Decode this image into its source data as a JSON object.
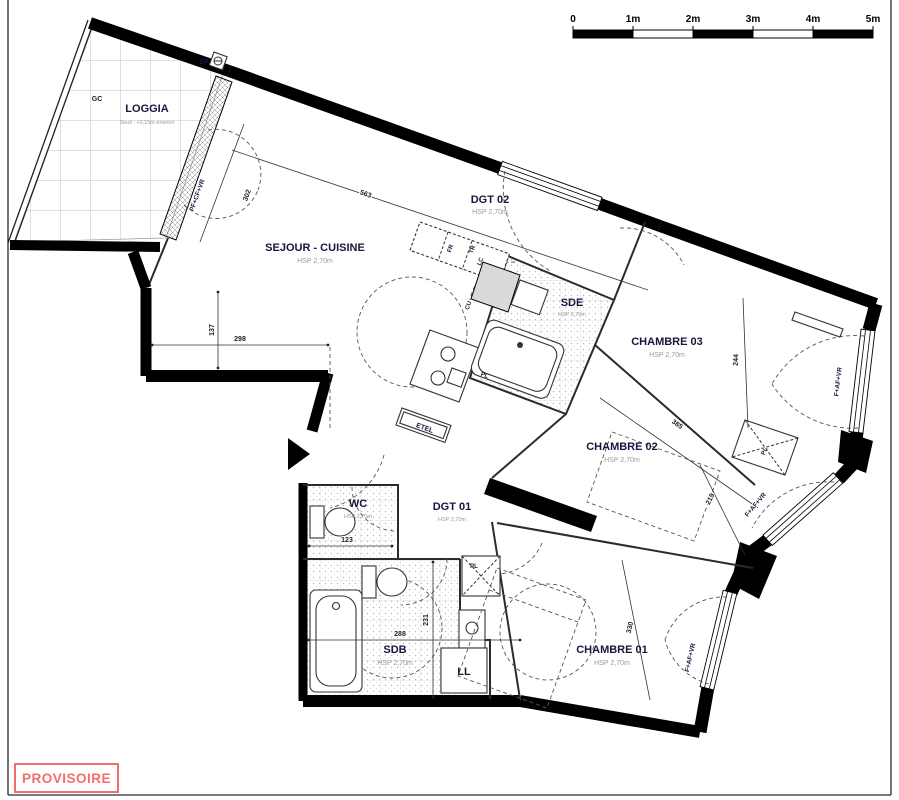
{
  "scale_bar": {
    "labels": [
      "0",
      "1m",
      "2m",
      "3m",
      "4m",
      "5m"
    ]
  },
  "stamp": {
    "label": "PROVISOIRE",
    "color": "#f26d6d"
  },
  "rooms": [
    {
      "id": "loggia",
      "name": "LOGGIA",
      "sub": "Seuil : +0,15m environ"
    },
    {
      "id": "sejour",
      "name": "SEJOUR - CUISINE",
      "sub": "HSP 2,70m"
    },
    {
      "id": "dgt02",
      "name": "DGT 02",
      "sub": "HSP 2,70m"
    },
    {
      "id": "sde",
      "name": "SDE",
      "sub": "HSP 2,70m"
    },
    {
      "id": "chambre03",
      "name": "CHAMBRE 03",
      "sub": "HSP 2,70m"
    },
    {
      "id": "chambre02",
      "name": "CHAMBRE 02",
      "sub": "HSP 2,70m"
    },
    {
      "id": "chambre01",
      "name": "CHAMBRE 01",
      "sub": "HSP 2,70m"
    },
    {
      "id": "wc",
      "name": "WC",
      "sub": "HSP 2,70m"
    },
    {
      "id": "dgt01",
      "name": "DGT 01",
      "sub": "HSP 2,70m"
    },
    {
      "id": "sdb",
      "name": "SDB",
      "sub": "HSP 2,70m"
    }
  ],
  "equipment": {
    "ll": "LL",
    "etel": "ETEL",
    "ep": "EP",
    "gc": "GC",
    "pl_ch03": "PL",
    "pl_dgt01": "PL",
    "pl_sde": "PL",
    "fr": "FR",
    "tr": "TR",
    "lc": "LC",
    "cu": "CU"
  },
  "windows": {
    "loggia": "PF+CF+VR",
    "ch03": "F+AF+VR",
    "ch02": "F+AF+VR",
    "ch01": "F+AF+VR"
  },
  "dimensions": {
    "sejour_top": "563",
    "loggia_door": "302",
    "sejour_left_h": "137",
    "sejour_left_w": "298",
    "wc_width": "123",
    "sdb_width": "288",
    "sdb_height": "231",
    "ch03_depth": "244",
    "ch02_width": "385",
    "ch02_depth": "219",
    "ch01_depth": "330"
  }
}
